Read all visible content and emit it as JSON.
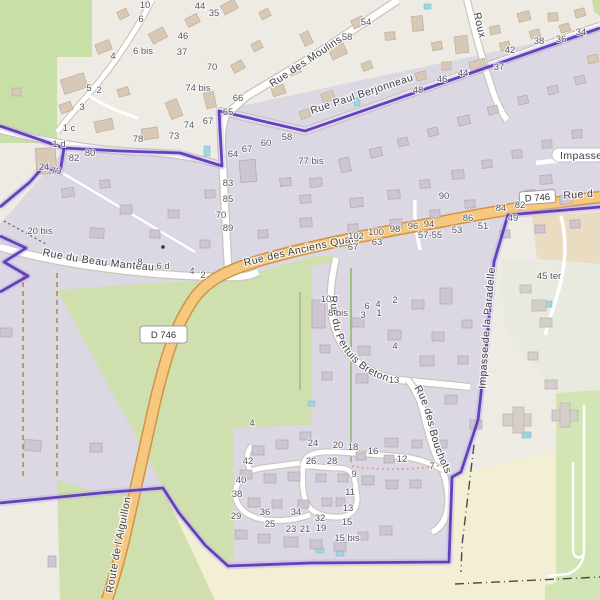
{
  "map": {
    "kind": "openstreetmap-street-map",
    "colors": {
      "boundary_purple": "#5a35b5",
      "road_primary_fill": "#f6c77f",
      "road_primary_casing": "#cf9447",
      "residential_fill": "#dbd8e4",
      "meadow_green": "#cfe0ae",
      "forest_green": "#c9dfa8",
      "farmland_yellow": "#f2efd5",
      "scrub_green": "#d3e4b5",
      "farmland_tan": "#e9dcc1",
      "water_blue": "#9fd4e2",
      "base": "#eeebe4"
    },
    "street_labels": {
      "moulins": "Rue des Moulins",
      "paul_berjonneau": "Rue Paul Berjonneau",
      "roux": "Roux",
      "anciens_quais": "Rue des Anciens Quais",
      "beau_manteau": "Rue du Beau Manteau",
      "pertuis_breton": "Rue du Pertuis Breton",
      "bouchots": "Rue des Bouchots",
      "aiguillon": "Route de l'Aiguillon",
      "paradelle": "Impasse de la Paradelle",
      "impasse": "Impasse",
      "d746_ref": "D 746",
      "d746_ref_top": "D 746",
      "rue_d_partial": "Rue d"
    },
    "house_numbers": [
      {
        "t": "10",
        "x": 145,
        "y": 8
      },
      {
        "t": "6",
        "x": 141,
        "y": 22
      },
      {
        "t": "44",
        "x": 200,
        "y": 9
      },
      {
        "t": "35",
        "x": 214,
        "y": 16
      },
      {
        "t": "46",
        "x": 183,
        "y": 39
      },
      {
        "t": "37",
        "x": 182,
        "y": 55
      },
      {
        "t": "70",
        "x": 212,
        "y": 70
      },
      {
        "t": "6 bis",
        "x": 143,
        "y": 54
      },
      {
        "t": "4",
        "x": 113,
        "y": 59
      },
      {
        "t": "5",
        "x": 89,
        "y": 91
      },
      {
        "t": "2",
        "x": 99,
        "y": 93
      },
      {
        "t": "3",
        "x": 82,
        "y": 110
      },
      {
        "t": "1 c",
        "x": 69,
        "y": 131
      },
      {
        "t": "1 d",
        "x": 59,
        "y": 147
      },
      {
        "t": "74 bis",
        "x": 198,
        "y": 91
      },
      {
        "t": "66",
        "x": 238,
        "y": 101
      },
      {
        "t": "65",
        "x": 228,
        "y": 115
      },
      {
        "t": "54",
        "x": 366,
        "y": 25
      },
      {
        "t": "58",
        "x": 347,
        "y": 40
      },
      {
        "t": "42",
        "x": 510,
        "y": 53
      },
      {
        "t": "38",
        "x": 539,
        "y": 44
      },
      {
        "t": "36",
        "x": 561,
        "y": 42
      },
      {
        "t": "34",
        "x": 581,
        "y": 35
      },
      {
        "t": "44",
        "x": 463,
        "y": 76
      },
      {
        "t": "46",
        "x": 442,
        "y": 82
      },
      {
        "t": "48",
        "x": 418,
        "y": 93
      },
      {
        "t": "37",
        "x": 499,
        "y": 70
      },
      {
        "t": "24",
        "x": 44,
        "y": 170
      },
      {
        "t": "79",
        "x": 56,
        "y": 174
      },
      {
        "t": "82",
        "x": 74,
        "y": 161
      },
      {
        "t": "80",
        "x": 90,
        "y": 156
      },
      {
        "t": "64",
        "x": 233,
        "y": 157
      },
      {
        "t": "67",
        "x": 247,
        "y": 152
      },
      {
        "t": "60",
        "x": 266,
        "y": 146
      },
      {
        "t": "58",
        "x": 287,
        "y": 140
      },
      {
        "t": "78",
        "x": 138,
        "y": 142
      },
      {
        "t": "73",
        "x": 174,
        "y": 139
      },
      {
        "t": "74",
        "x": 189,
        "y": 128
      },
      {
        "t": "67",
        "x": 208,
        "y": 124
      },
      {
        "t": "77 bis",
        "x": 311,
        "y": 164
      },
      {
        "t": "90",
        "x": 444,
        "y": 199
      },
      {
        "t": "83",
        "x": 228,
        "y": 186
      },
      {
        "t": "85",
        "x": 228,
        "y": 202
      },
      {
        "t": "70",
        "x": 221,
        "y": 218
      },
      {
        "t": "89",
        "x": 228,
        "y": 231
      },
      {
        "t": "20 bis",
        "x": 40,
        "y": 234
      },
      {
        "t": "102",
        "x": 356,
        "y": 239
      },
      {
        "t": "100",
        "x": 376,
        "y": 235
      },
      {
        "t": "98",
        "x": 395,
        "y": 232
      },
      {
        "t": "96",
        "x": 413,
        "y": 229
      },
      {
        "t": "94",
        "x": 429,
        "y": 227
      },
      {
        "t": "86",
        "x": 468,
        "y": 221
      },
      {
        "t": "84",
        "x": 501,
        "y": 211
      },
      {
        "t": "82",
        "x": 520,
        "y": 208
      },
      {
        "t": "49",
        "x": 513,
        "y": 221
      },
      {
        "t": "67",
        "x": 353,
        "y": 250
      },
      {
        "t": "63",
        "x": 377,
        "y": 245
      },
      {
        "t": "57-55",
        "x": 430,
        "y": 238
      },
      {
        "t": "53",
        "x": 457,
        "y": 233
      },
      {
        "t": "51",
        "x": 483,
        "y": 229
      },
      {
        "t": "8",
        "x": 140,
        "y": 265
      },
      {
        "t": "6 d",
        "x": 163,
        "y": 269
      },
      {
        "t": "4",
        "x": 192,
        "y": 274
      },
      {
        "t": "2",
        "x": 203,
        "y": 278
      },
      {
        "t": "45 ter",
        "x": 549,
        "y": 279
      },
      {
        "t": "10",
        "x": 326,
        "y": 302
      },
      {
        "t": "8 bis",
        "x": 338,
        "y": 316
      },
      {
        "t": "6",
        "x": 367,
        "y": 309
      },
      {
        "t": "4",
        "x": 378,
        "y": 307
      },
      {
        "t": "2",
        "x": 395,
        "y": 303
      },
      {
        "t": "3",
        "x": 363,
        "y": 318
      },
      {
        "t": "1",
        "x": 379,
        "y": 316
      },
      {
        "t": "4",
        "x": 395,
        "y": 349
      },
      {
        "t": "13",
        "x": 394,
        "y": 383
      },
      {
        "t": "24",
        "x": 313,
        "y": 446
      },
      {
        "t": "20",
        "x": 338,
        "y": 448
      },
      {
        "t": "18",
        "x": 353,
        "y": 450
      },
      {
        "t": "16",
        "x": 373,
        "y": 454
      },
      {
        "t": "12",
        "x": 402,
        "y": 462
      },
      {
        "t": "7",
        "x": 432,
        "y": 469
      },
      {
        "t": "26",
        "x": 311,
        "y": 464
      },
      {
        "t": "28",
        "x": 332,
        "y": 464
      },
      {
        "t": "9",
        "x": 354,
        "y": 477
      },
      {
        "t": "11",
        "x": 350,
        "y": 495
      },
      {
        "t": "13",
        "x": 348,
        "y": 511
      },
      {
        "t": "15",
        "x": 347,
        "y": 525
      },
      {
        "t": "15 bis",
        "x": 347,
        "y": 541
      },
      {
        "t": "42",
        "x": 248,
        "y": 464
      },
      {
        "t": "40",
        "x": 241,
        "y": 483
      },
      {
        "t": "38",
        "x": 237,
        "y": 497
      },
      {
        "t": "29",
        "x": 236,
        "y": 519
      },
      {
        "t": "36",
        "x": 265,
        "y": 515
      },
      {
        "t": "25",
        "x": 270,
        "y": 527
      },
      {
        "t": "34",
        "x": 296,
        "y": 515
      },
      {
        "t": "32",
        "x": 320,
        "y": 521
      },
      {
        "t": "23",
        "x": 291,
        "y": 532
      },
      {
        "t": "21",
        "x": 305,
        "y": 532
      },
      {
        "t": "19",
        "x": 321,
        "y": 531
      },
      {
        "t": "4",
        "x": 252,
        "y": 426
      }
    ]
  }
}
